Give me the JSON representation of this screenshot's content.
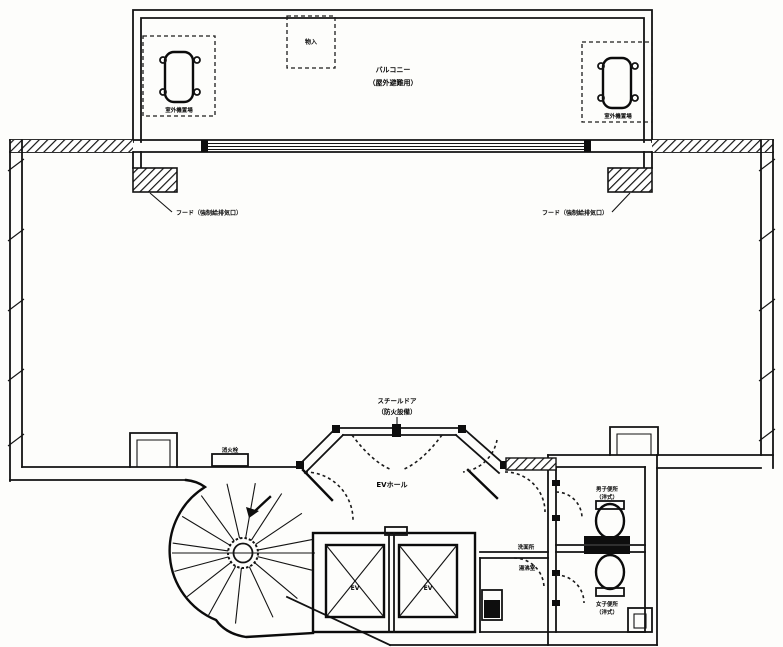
{
  "labels": {
    "balcony": {
      "line1": "バルコニー",
      "line2": "（屋外避難用）"
    },
    "outdoor_unit_left": "室外機置場",
    "outdoor_unit_right": "室外機置場",
    "storage": "物入",
    "hood_left": "フード（強制給排気口）",
    "hood_right": "フード（強制給排気口）",
    "steel_door": {
      "line1": "スチールドア",
      "line2": "（防火設備）"
    },
    "ev_hall": "EVホール",
    "fixture": "消火栓",
    "washroom": "洗面所",
    "kitchenette": "湯沸室",
    "wc_upper": {
      "line1": "男子便所",
      "line2": "（洋式）"
    },
    "wc_lower": {
      "line1": "女子便所",
      "line2": "（洋式）"
    },
    "ev_left": "EV",
    "ev_right": "EV"
  },
  "colors": {
    "line": "#1b1b1b",
    "paper": "#fdfdfb"
  }
}
